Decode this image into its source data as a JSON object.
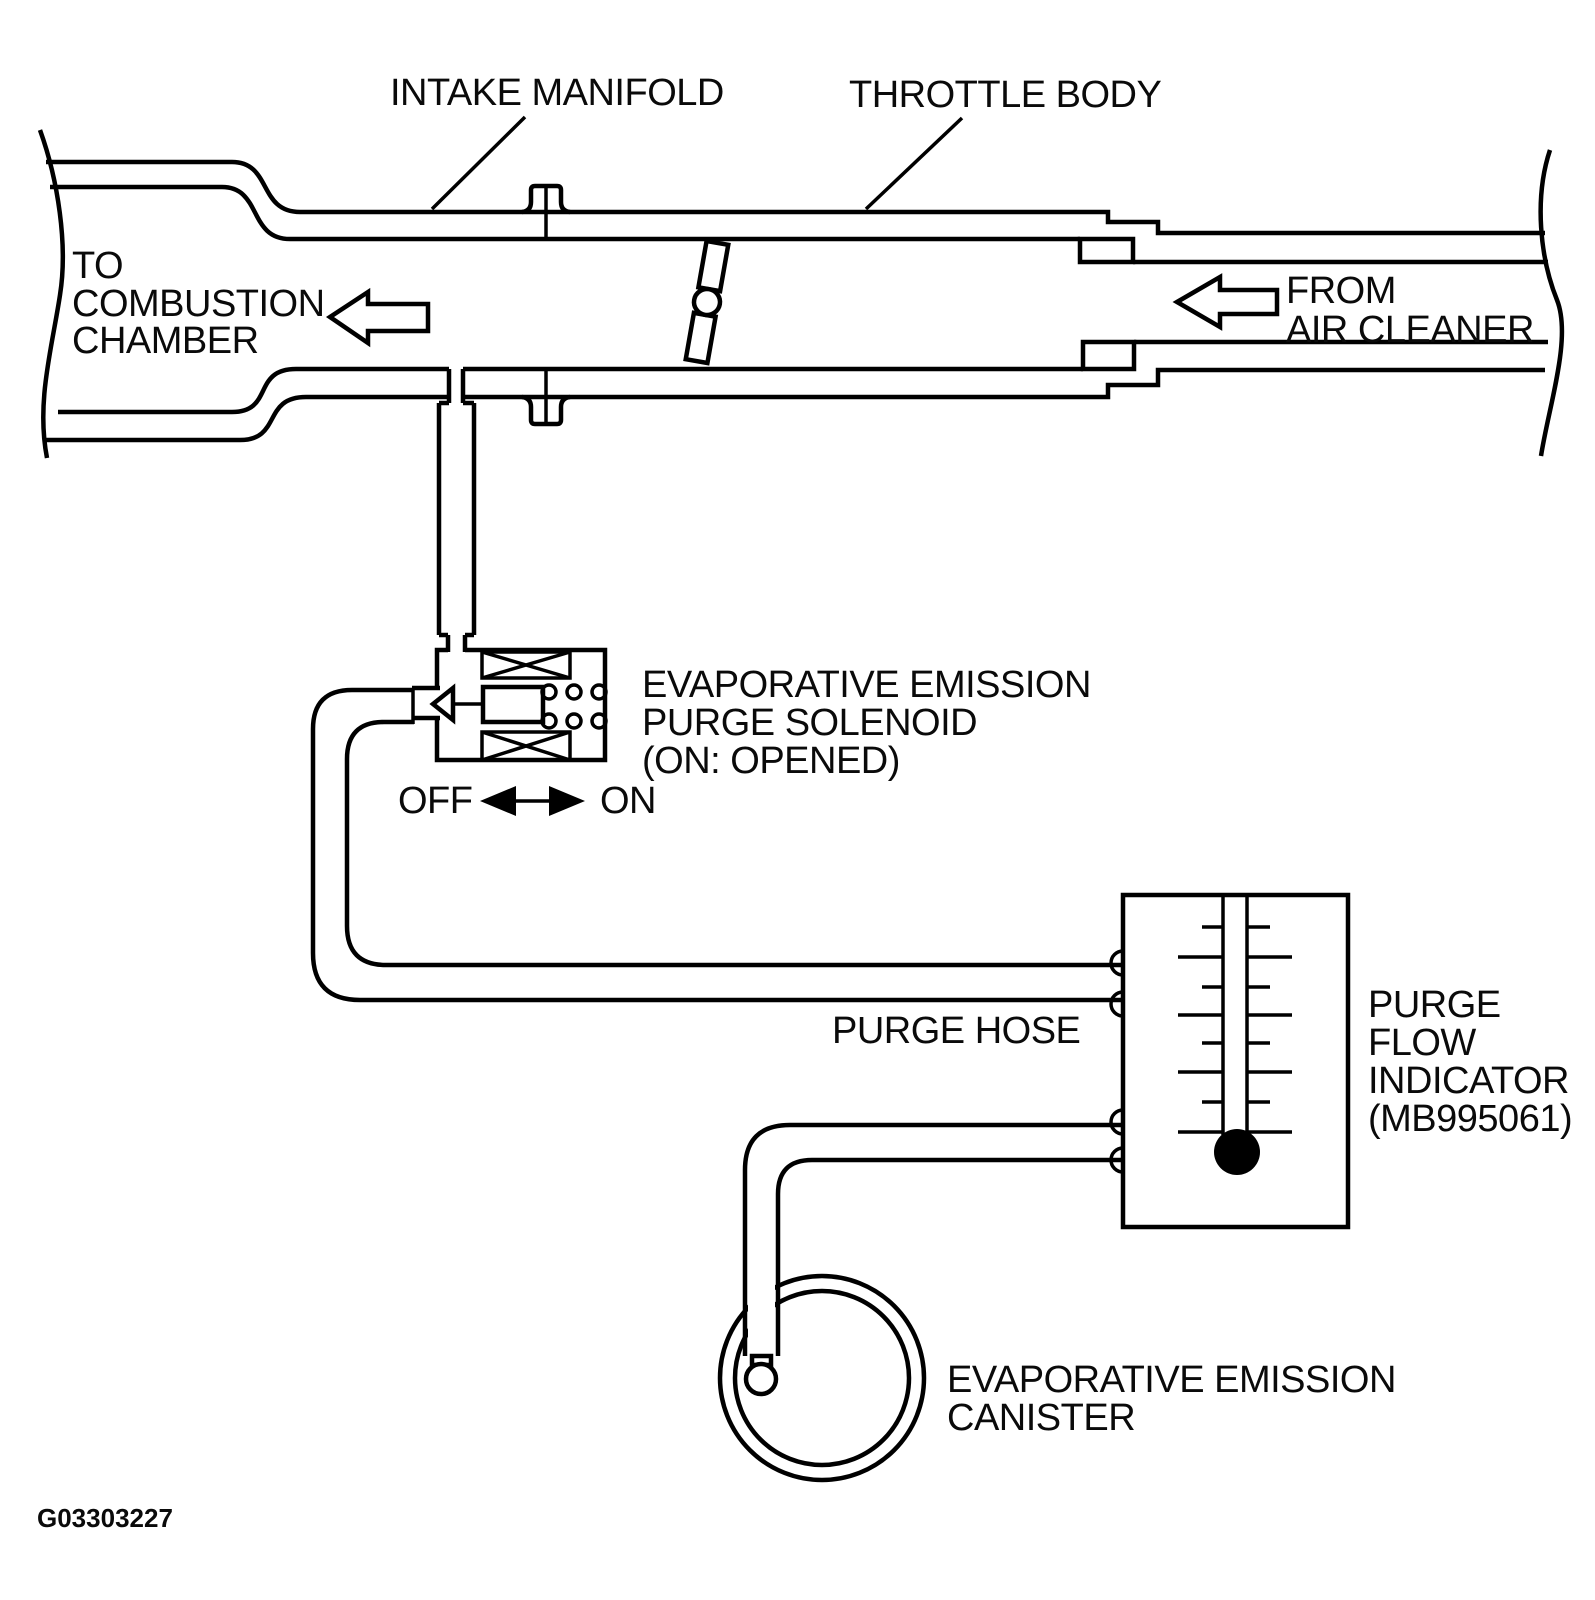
{
  "document": {
    "type": "evaporative-emission-purge-system-diagram",
    "figure_code": "G03303227",
    "background_color": "#ffffff",
    "line_color": "#000000"
  },
  "labels": {
    "intake_manifold": "INTAKE MANIFOLD",
    "throttle_body": "THROTTLE BODY",
    "to_combustion_chamber": {
      "line1": "TO",
      "line2": "COMBUSTION",
      "line3": "CHAMBER"
    },
    "from_air_cleaner": {
      "line1": "FROM",
      "line2": "AIR CLEANER"
    },
    "purge_solenoid": {
      "line1": "EVAPORATIVE EMISSION",
      "line2": "PURGE SOLENOID",
      "line3": "(ON: OPENED)"
    },
    "solenoid_states": {
      "off": "OFF",
      "on": "ON"
    },
    "purge_hose": "PURGE HOSE",
    "purge_flow_indicator": {
      "line1": "PURGE",
      "line2": "FLOW",
      "line3": "INDICATOR",
      "line4": "(MB995061)"
    },
    "evap_canister": {
      "line1": "EVAPORATIVE EMISSION",
      "line2": "CANISTER"
    }
  }
}
